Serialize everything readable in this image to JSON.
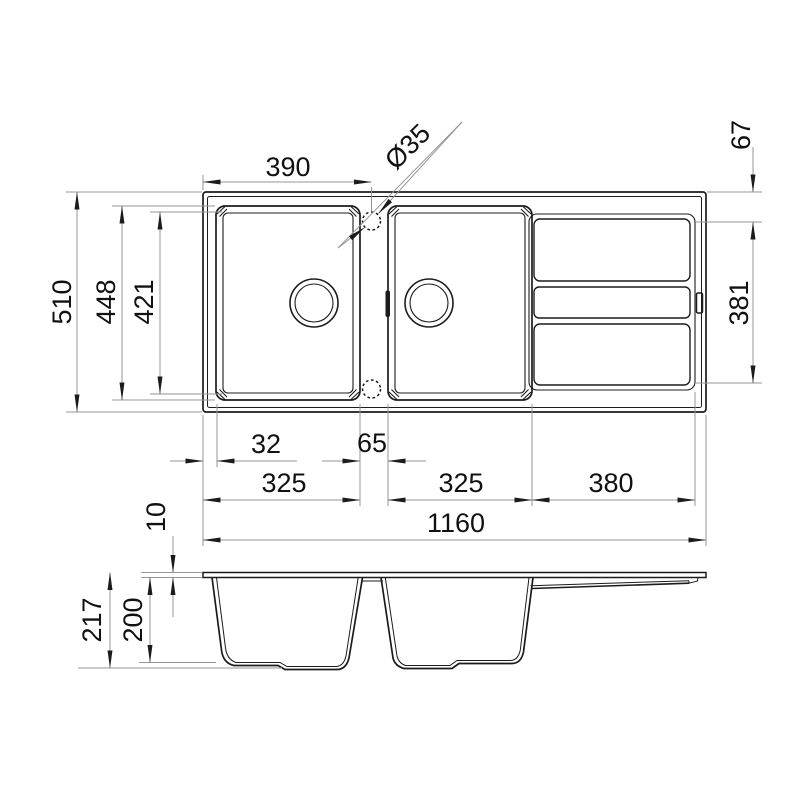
{
  "colors": {
    "background": "#ffffff",
    "object_line": "#1c1c1c",
    "dimension_line": "#969696",
    "text": "#111111"
  },
  "views": {
    "plan": {
      "description": "top view of double-bowl sink with drainer",
      "dimensions": {
        "d390": "390",
        "d35": "Ø35",
        "d67": "67",
        "d510": "510",
        "d448": "448",
        "d421": "421",
        "d381": "381",
        "d32": "32",
        "d65": "65",
        "d325a": "325",
        "d325b": "325",
        "d380": "380",
        "d1160": "1160"
      }
    },
    "section": {
      "description": "side section view of sink bowls",
      "dimensions": {
        "d10": "10",
        "d217": "217",
        "d200": "200"
      }
    }
  }
}
